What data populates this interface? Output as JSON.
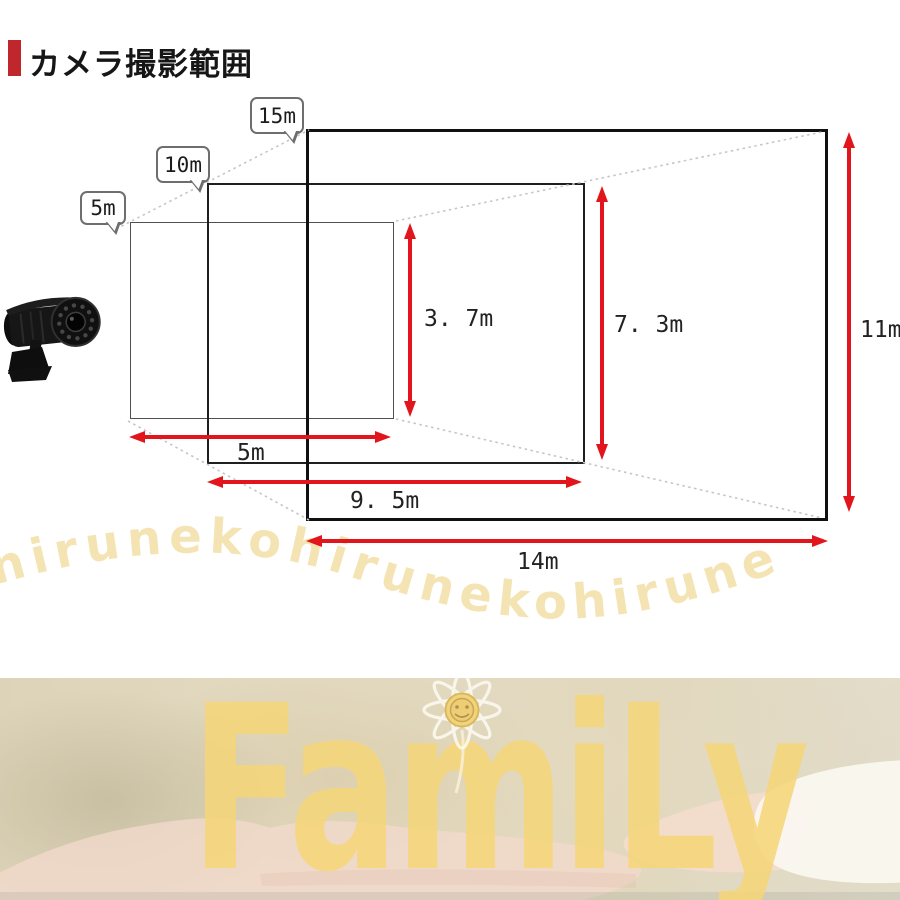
{
  "header": {
    "title": "カメラ撮影範囲",
    "accent_color": "#c0272d"
  },
  "diagram": {
    "distance_labels": [
      {
        "label": "5m"
      },
      {
        "label": "10m"
      },
      {
        "label": "15m"
      }
    ],
    "measurements": [
      {
        "distance": "5m",
        "width": "5m",
        "height": "3. 7m"
      },
      {
        "distance": "10m",
        "width": "9. 5m",
        "height": "7. 3m"
      },
      {
        "distance": "15m",
        "width": "14m",
        "height": "11m"
      }
    ],
    "arrow_color": "#e2151d",
    "camera_icon": "security-camera-icon"
  },
  "watermark": {
    "text": "hirunekohirunekohirune",
    "color": "#f5e4b3"
  },
  "banner": {
    "word": "FamiLy",
    "word_color": "#f6d677",
    "flower_icon": "daisy-flower-icon"
  }
}
